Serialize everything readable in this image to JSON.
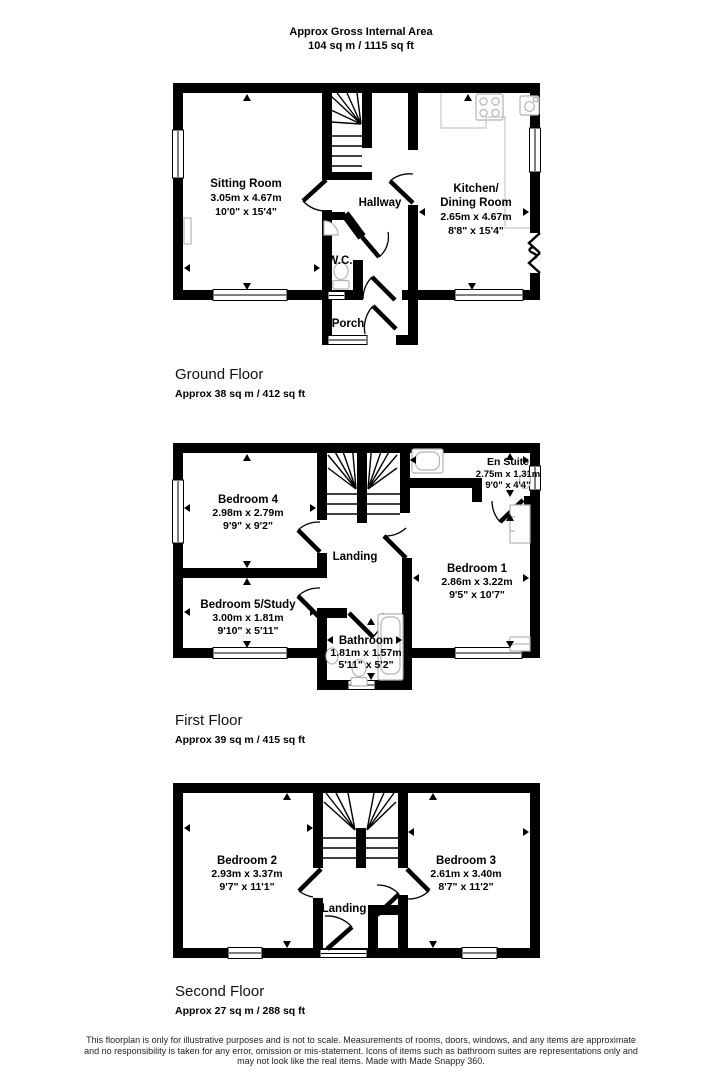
{
  "header": {
    "line1": "Approx Gross Internal Area",
    "line2": "104 sq m / 1115 sq ft"
  },
  "floors": [
    {
      "title": "Ground Floor",
      "area": "Approx 38 sq m / 412 sq ft",
      "rooms": {
        "sitting": {
          "name": "Sitting Room",
          "metric": "3.05m x 4.67m",
          "imperial": "10'0\" x 15'4\""
        },
        "hallway": {
          "name": "Hallway"
        },
        "kitchen": {
          "name_line1": "Kitchen/",
          "name_line2": "Dining Room",
          "metric": "2.65m x 4.67m",
          "imperial": "8'8\" x 15'4\""
        },
        "wc": {
          "name": "W.C."
        },
        "porch": {
          "name": "Porch"
        }
      }
    },
    {
      "title": "First Floor",
      "area": "Approx 39 sq m / 415 sq ft",
      "rooms": {
        "bedroom4": {
          "name": "Bedroom 4",
          "metric": "2.98m x 2.79m",
          "imperial": "9'9\" x 9'2\""
        },
        "bedroom5": {
          "name": "Bedroom 5/Study",
          "metric": "3.00m x 1.81m",
          "imperial": "9'10\" x 5'11\""
        },
        "landing": {
          "name": "Landing"
        },
        "ensuite": {
          "name": "En Suite",
          "metric": "2.75m x 1.31m",
          "imperial": "9'0\" x 4'4\""
        },
        "bedroom1": {
          "name": "Bedroom 1",
          "metric": "2.86m x 3.22m",
          "imperial": "9'5\" x 10'7\""
        },
        "bathroom": {
          "name": "Bathroom",
          "metric": "1.81m x 1.57m",
          "imperial": "5'11\" x 5'2\""
        }
      }
    },
    {
      "title": "Second Floor",
      "area": "Approx 27 sq m / 288 sq ft",
      "rooms": {
        "bedroom2": {
          "name": "Bedroom 2",
          "metric": "2.93m x 3.37m",
          "imperial": "9'7\" x 11'1\""
        },
        "bedroom3": {
          "name": "Bedroom 3",
          "metric": "2.61m x 3.40m",
          "imperial": "8'7\" x 11'2\""
        },
        "landing": {
          "name": "Landing"
        }
      }
    }
  ],
  "footer": {
    "line1": "This floorplan is only for illustrative purposes and is not to scale. Measurements of rooms, doors, windows, and any items are approximate",
    "line2": "and no responsibility is taken for any error, omission or mis-statement. Icons of items such as bathroom suites are representations only and",
    "line3": "may not look like the real items. Made with Made Snappy 360."
  }
}
